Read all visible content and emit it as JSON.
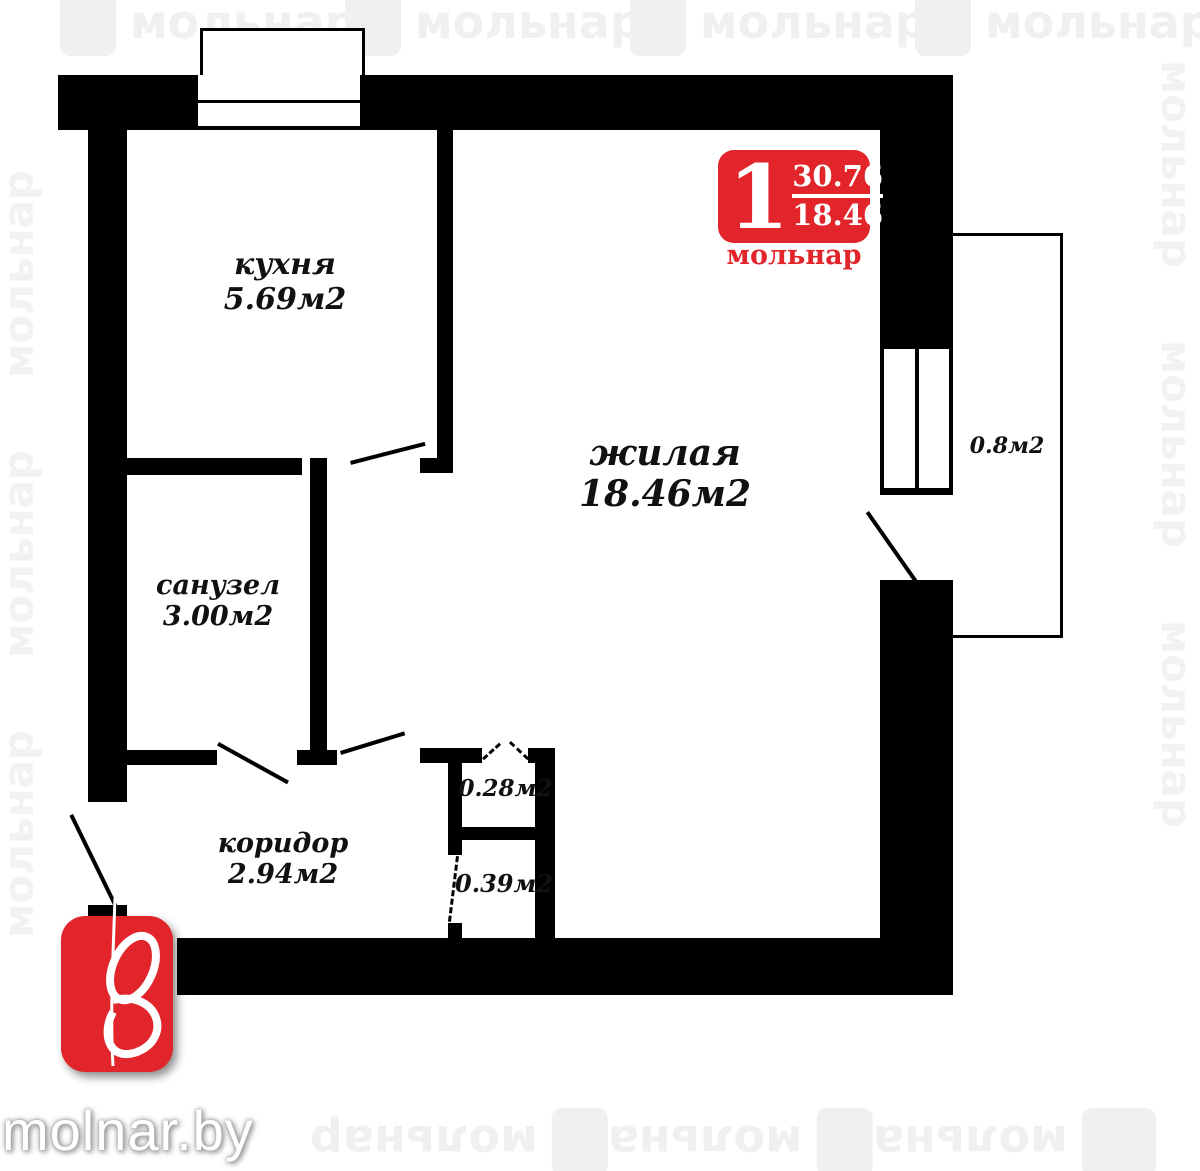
{
  "watermark": {
    "text": "мольнар"
  },
  "site": {
    "name": "molnar.by"
  },
  "badge": {
    "rooms_count": "1",
    "total_area": "30.76",
    "living_area": "18.46",
    "brand": "мольнар"
  },
  "rooms": {
    "kitchen": {
      "name": "кухня",
      "area": "5.69м2"
    },
    "living": {
      "name": "жилая",
      "area": "18.46м2"
    },
    "bathroom": {
      "name": "санузел",
      "area": "3.00м2"
    },
    "corridor": {
      "name": "коридор",
      "area": "2.94м2"
    },
    "closet_small": {
      "area": "0.28м2"
    },
    "closet_large": {
      "area": "0.39м2"
    },
    "balcony": {
      "area": "0.8м2"
    }
  },
  "colors": {
    "wall": "#000000",
    "brand_red": "#e2242b",
    "watermark_gray": "#f0f0f0"
  }
}
